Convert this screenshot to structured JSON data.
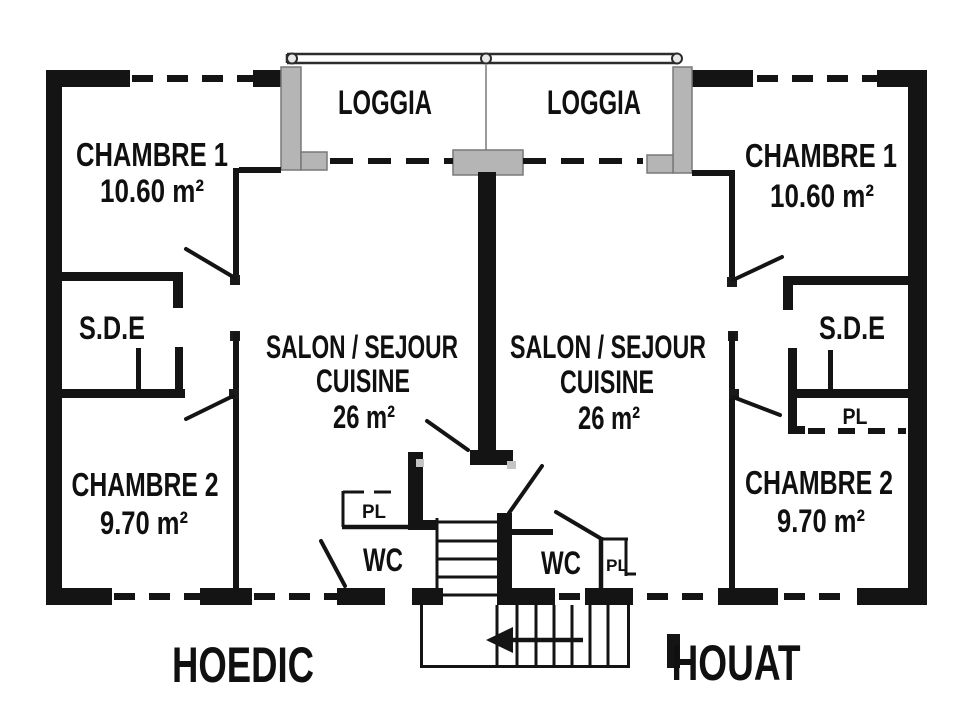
{
  "apartments": {
    "left": {
      "name": "HOEDIC",
      "loggia": "LOGGIA",
      "chambre1": "CHAMBRE 1",
      "chambre1_area": "10.60 m²",
      "sde": "S.D.E",
      "salon_line1": "SALON / SEJOUR",
      "salon_line2": "CUISINE",
      "salon_area": "26 m²",
      "chambre2": "CHAMBRE 2",
      "chambre2_area": "9.70 m²",
      "pl": "PL",
      "wc": "WC"
    },
    "right": {
      "name": "HOUAT",
      "loggia": "LOGGIA",
      "chambre1": "CHAMBRE 1",
      "chambre1_area": "10.60 m²",
      "sde": "S.D.E",
      "sde_pl": "PL",
      "salon_line1": "SALON / SEJOUR",
      "salon_line2": "CUISINE",
      "salon_area": "26 m²",
      "chambre2": "CHAMBRE 2",
      "chambre2_area": "9.70 m²",
      "pl": "PL",
      "wc": "WC"
    }
  },
  "colors": {
    "wall": "#141414",
    "pillar": "#b5b5b5",
    "background": "#ffffff"
  }
}
